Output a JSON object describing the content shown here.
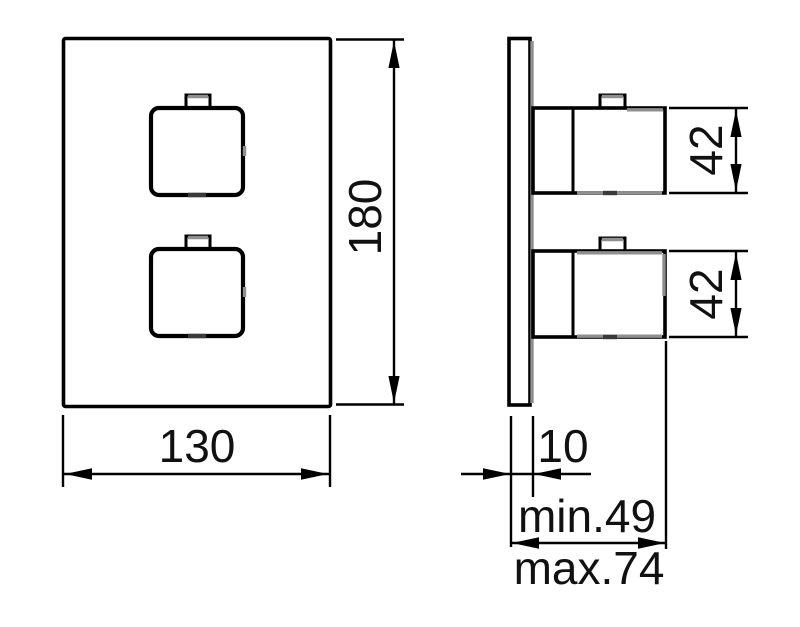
{
  "canvas": {
    "background_color": "#ffffff",
    "line_color": "#000000",
    "shade_color": "#8f8f8f",
    "text_color": "#111111"
  },
  "front_view": {
    "width_dim": "130",
    "height_dim": "180"
  },
  "side_view": {
    "handle_top_dim": "42",
    "handle_bottom_dim": "42",
    "plate_thickness_dim": "10",
    "depth_min_dim": "min.49",
    "depth_max_dim": "max.74"
  }
}
